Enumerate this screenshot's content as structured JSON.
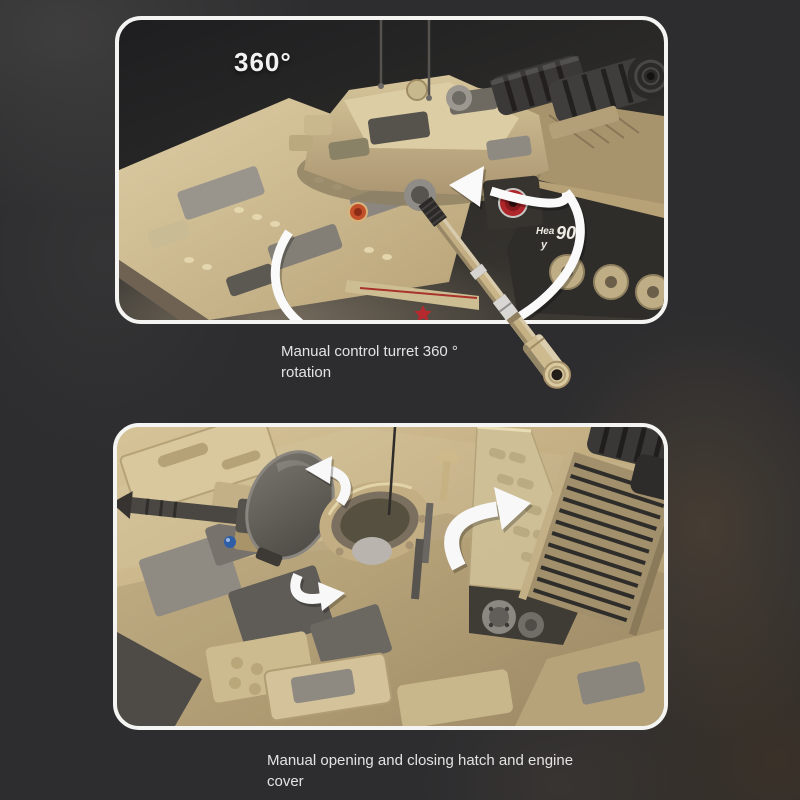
{
  "page": {
    "background_color": "#2d2d2f",
    "panel_border_color": "#f4f4f2"
  },
  "panels": {
    "top": {
      "name": "turret-rotation-demo-photo",
      "badge": "360°",
      "caption_lines": [
        "Manual control turret 360 °",
        "rotation"
      ],
      "hull_marking": {
        "prefix": "Hea",
        "number": "90",
        "suffix": "y"
      },
      "annotations": [
        "rotation-ellipse-arrow"
      ]
    },
    "bottom": {
      "name": "hatch-engine-demo-photo",
      "caption_lines": [
        "Manual opening and closing hatch and engine",
        "cover"
      ],
      "annotations": [
        "curved-arrow-up-left",
        "curved-arrow-right",
        "curved-arrow-up-right"
      ]
    }
  },
  "colors": {
    "caption_text": "#e3e3e3",
    "annotation_white": "#f8f8f8",
    "brick_tan": "#c9b488",
    "brick_tan_light": "#dbcba1",
    "camo_gray": "#8f8b83",
    "camo_dark_gray": "#56534d",
    "track_black": "#2f2d2a",
    "red_accent": "#b4262c"
  }
}
